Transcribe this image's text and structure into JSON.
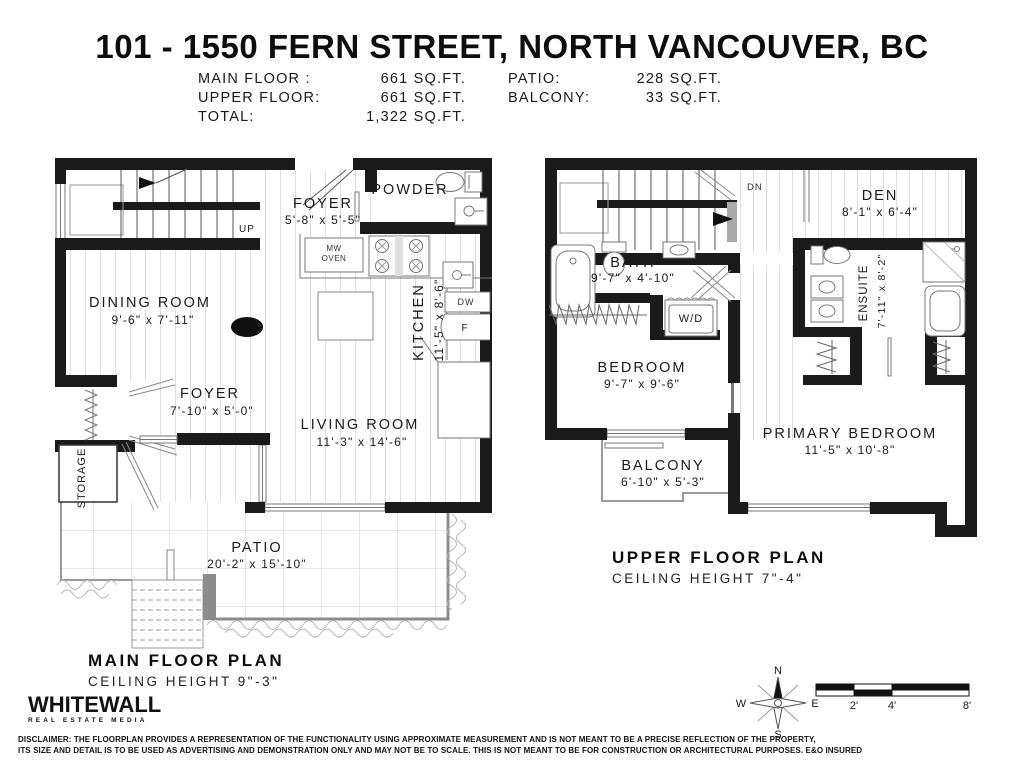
{
  "title": "101 - 1550 FERN STREET, NORTH VANCOUVER, BC",
  "areas": {
    "rows_left": [
      {
        "label": "MAIN FLOOR :",
        "value": "661 SQ.FT."
      },
      {
        "label": "UPPER FLOOR:",
        "value": "661 SQ.FT."
      },
      {
        "label": "TOTAL:",
        "value": "1,322 SQ.FT."
      }
    ],
    "rows_right": [
      {
        "label": "PATIO:",
        "value": "228 SQ.FT."
      },
      {
        "label": "BALCONY:",
        "value": "33 SQ.FT."
      }
    ]
  },
  "main_floor": {
    "plan_title": "MAIN FLOOR PLAN",
    "ceiling": "CEILING HEIGHT 9\"-3\"",
    "rooms": {
      "foyer_upper": {
        "name": "FOYER",
        "dims": "5'-8\" x 5'-5\""
      },
      "powder": {
        "name": "POWDER"
      },
      "kitchen": {
        "name": "KITCHEN",
        "dims": "11'-5\" x 8'-6\""
      },
      "dining": {
        "name": "DINING ROOM",
        "dims": "9'-6\" x 7'-11\""
      },
      "foyer_lower": {
        "name": "FOYER",
        "dims": "7'-10\" x 5'-0\""
      },
      "living": {
        "name": "LIVING ROOM",
        "dims": "11'-3\" x 14'-6\""
      },
      "storage": {
        "name": "STORAGE"
      },
      "patio": {
        "name": "PATIO",
        "dims": "20'-2\" x 15'-10\""
      }
    },
    "labels": {
      "up": "UP",
      "mw": "MW",
      "oven": "OVEN",
      "dw": "DW",
      "fridge": "F"
    }
  },
  "upper_floor": {
    "plan_title": "UPPER FLOOR PLAN",
    "ceiling": "CEILING HEIGHT 7\"-4\"",
    "rooms": {
      "den": {
        "name": "DEN",
        "dims": "8'-1\" x 6'-4\""
      },
      "bath": {
        "name": "BATH",
        "dims": "9'-7\" x 4'-10\""
      },
      "ensuite": {
        "name": "ENSUITE",
        "dims": "7'-11\" x 8'-2\""
      },
      "bedroom": {
        "name": "BEDROOM",
        "dims": "9'-7\" x 9'-6\""
      },
      "primary": {
        "name": "PRIMARY BEDROOM",
        "dims": "11'-5\" x 10'-8\""
      },
      "balcony": {
        "name": "BALCONY",
        "dims": "6'-10\" x 5'-3\""
      }
    },
    "labels": {
      "dn": "DN",
      "wd": "W/D"
    }
  },
  "footer": {
    "logo": {
      "name": "WHITEWALL",
      "tagline": "REAL ESTATE MEDIA"
    },
    "compass": {
      "n": "N",
      "s": "S",
      "e": "E",
      "w": "W"
    },
    "scale": {
      "m2": "2'",
      "m4": "4'",
      "m8": "8'"
    },
    "disclaimer_line1": "DISCLAIMER: THE FLOORPLAN PROVIDES A REPRESENTATION OF THE FUNCTIONALITY USING APPROXIMATE MEASUREMENT AND IS NOT MEANT TO BE A PRECISE REFLECTION OF THE PROPERTY,",
    "disclaimer_line2": "ITS SIZE AND DETAIL IS TO BE USED AS ADVERTISING AND DEMONSTRATION ONLY AND MAY NOT BE TO SCALE. THIS IS NOT MEANT TO BE FOR CONSTRUCTION OR ARCHITECTURAL PURPOSES. E&O INSURED"
  }
}
